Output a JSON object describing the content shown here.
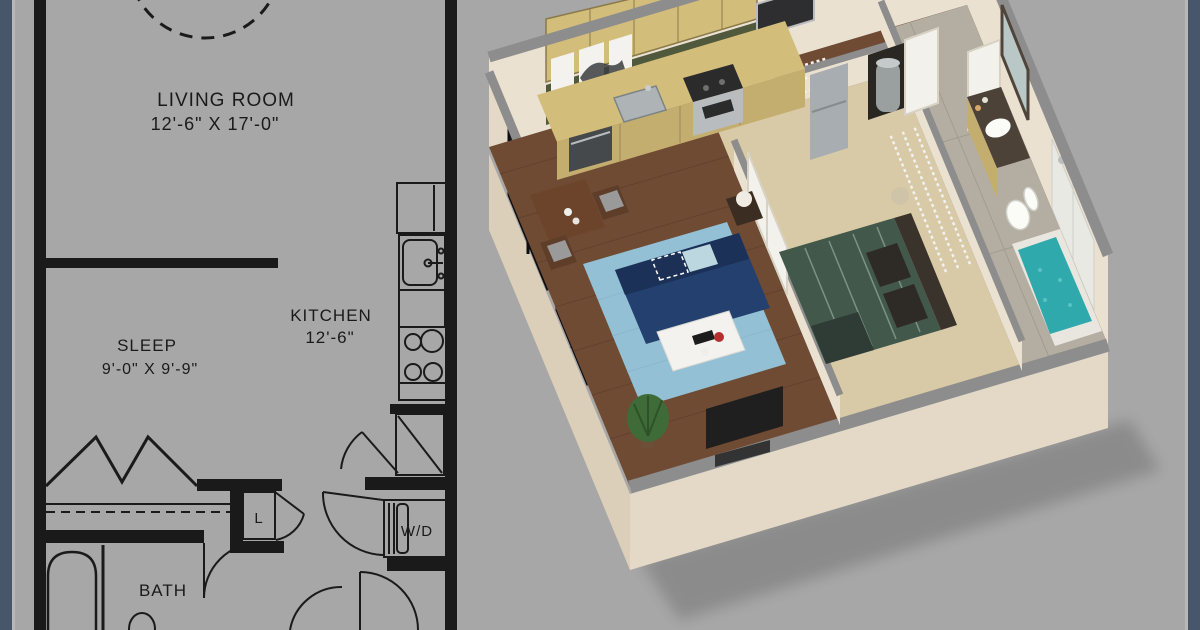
{
  "title": "Apartment floor plan with 2D drawing and 3D dollhouse render",
  "plan_2d": {
    "rooms": {
      "living_room": {
        "label": "LIVING ROOM",
        "dims": "12'-6\" X 17'-0\""
      },
      "kitchen": {
        "label": "KITCHEN",
        "dims": "12'-6\""
      },
      "sleep": {
        "label": "SLEEP",
        "dims": "9'-0\" X 9'-9\""
      },
      "bath": {
        "label": "BATH"
      },
      "linen_closet": {
        "label": "L"
      },
      "washer_dryer": {
        "label": "W/D"
      }
    },
    "fixtures": [
      "refrigerator",
      "kitchen-sink",
      "range-4-burner",
      "bathtub",
      "bath-sink",
      "bifold-closet-doors",
      "closet-rod",
      "entry-door",
      "washer-dryer-unit",
      "door-swings",
      "dashed-table-outline"
    ]
  },
  "render_3d": {
    "style": "isometric cutaway dollhouse render",
    "objects": [
      "navy-sofa",
      "chevron-pillow",
      "blue-pillow",
      "light-blue-rug",
      "white-coffee-table",
      "laptop",
      "red-flowers",
      "tv",
      "potted-plant",
      "side-table-lamp",
      "dining-table",
      "dining-chairs",
      "horse-art-triptych",
      "floor-to-ceiling-windows",
      "kitchen-cabinets",
      "green-backsplash",
      "kitchen-sink",
      "dishwasher",
      "range",
      "refrigerator",
      "microwave-oven",
      "bed-green-patterned",
      "dark-headboard",
      "pillows",
      "nightstand",
      "wire-closet-shelving",
      "white-french-doors",
      "hall-closet-doors",
      "water-heater",
      "bath-vanity",
      "vanity-mirror",
      "toilet",
      "teal-tile-tub",
      "shower-wall-tile",
      "wood-flooring",
      "tan-carpet",
      "tile-floor"
    ]
  },
  "colors": {
    "bg": "#a7a7a7",
    "strip": "#47566a",
    "stripEdge": "#b8b8b8",
    "ink": "#1a1a1a",
    "wall": "#ebe1d1",
    "wallShade": "#dbcfba",
    "wallSide": "#e4d9c6",
    "cap": "#8d8d8d",
    "wood": "#6f4b34",
    "woodLine": "#5b3b27",
    "carpet": "#d8caa6",
    "tile": "#b4aea2",
    "tileLine": "#a29c8f",
    "rug": "#93c0d5",
    "sofa": "#24406e",
    "sofaDark": "#1b3158",
    "pillowBlue": "#bcd7df",
    "pillowNavy": "#1c2f55",
    "tableWood": "#6b442b",
    "chairSeat": "#9a9a9a",
    "whiteSurf": "#f3f2ee",
    "cabinet": "#d3bd7b",
    "cabinetFront": "#c4ae6f",
    "splash": "#50593c",
    "steel": "#b9bcbe",
    "steelDark": "#46494b",
    "fridge": "#a7adb1",
    "darkSlab": "#1f1f1f",
    "bed": "#42584a",
    "bedLine": "#8ba293",
    "headboard": "#3a332c",
    "throw": "#2f3b35",
    "counterTop": "#4c4238",
    "teal": "#2fa9ac",
    "tealLight": "#57c2c4",
    "plant": "#3f6b38",
    "pot": "#6d4f38",
    "red": "#b43030",
    "windowDark": "#1b1d22",
    "shelf": "#f2f2f2",
    "doorWhite": "#f3f1ec",
    "doorEdge": "#d8d2c4",
    "heater": "#9aa0a0",
    "closetDark": "#2a2722",
    "mirror": "#b9c7c6",
    "mirrorFrame": "#50453a",
    "porcelain": "#fbfbf8"
  }
}
